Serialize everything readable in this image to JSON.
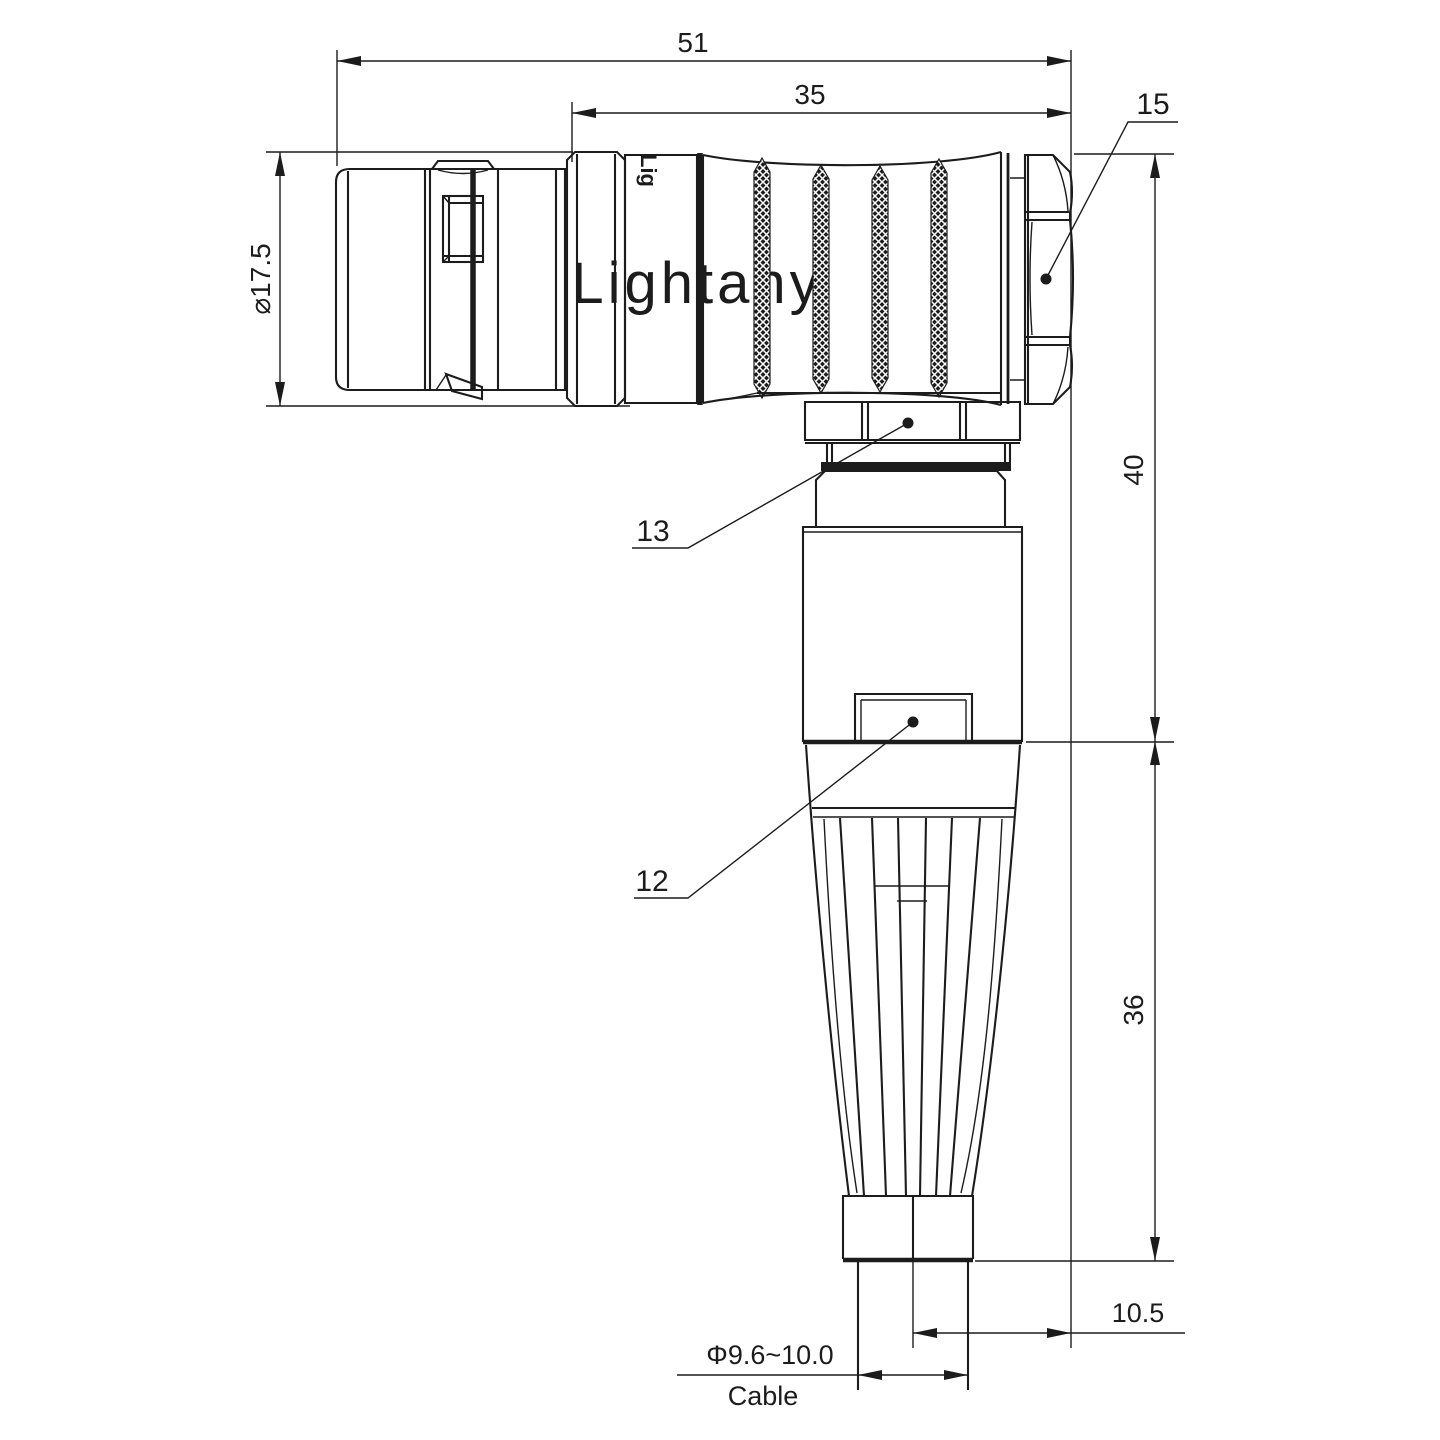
{
  "drawing": {
    "watermark_text": "Lightany",
    "body_print": "Lig",
    "dims": {
      "overall_length": "51",
      "rear_length": "35",
      "collar_diameter": "⌀17.5",
      "upper_height": "40",
      "lower_height": "36",
      "cable_offset": "10.5",
      "cable_diameter": "Φ9.6~10.0",
      "cable_word": "Cable"
    },
    "labels": {
      "hex_nut": "15",
      "coupling_nut": "13",
      "housing": "12"
    },
    "colors": {
      "line": "#1c1c1c",
      "watermark": "#f8d5d5",
      "background": "#ffffff"
    }
  }
}
